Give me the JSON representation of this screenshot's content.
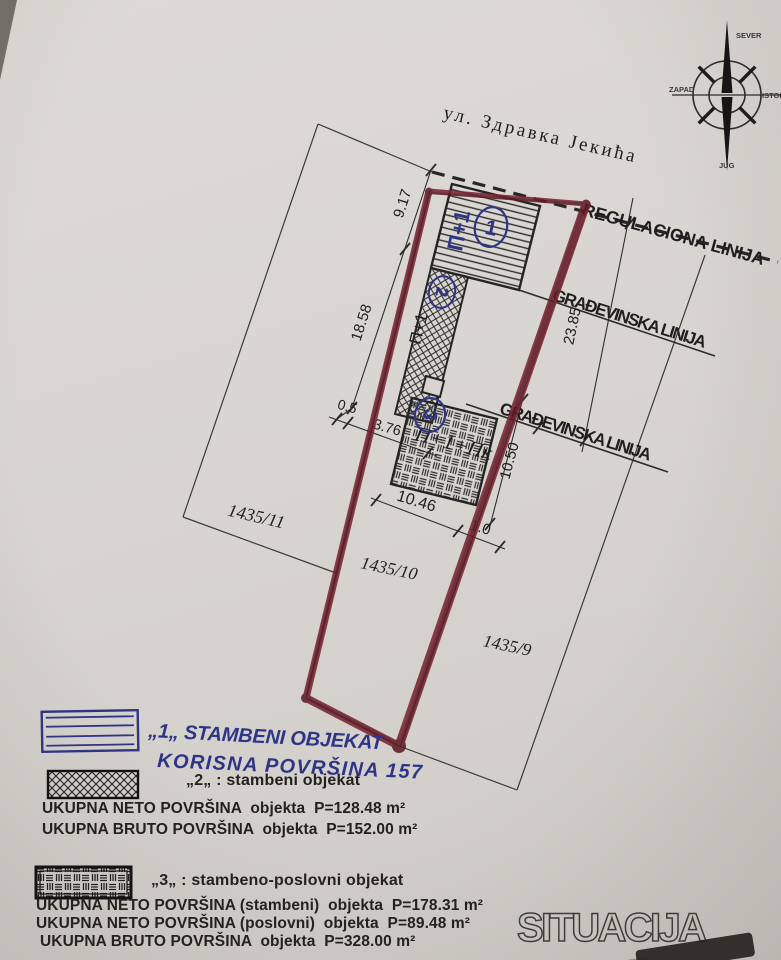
{
  "compass": {
    "north": "SEVER",
    "west": "ZAPAD",
    "east": "ISTOK",
    "south": "JUG"
  },
  "street": {
    "name": "ул. Здравка Јекића"
  },
  "plan": {
    "regulation_line": "REGULACIONA LINIJA",
    "building_line_upper": "GRAĐEVINSKA LINIJA",
    "building_line_lower": "GRAĐEVINSKA LINIJA",
    "parcel_left": "1435/11",
    "parcel_middle": "1435/10",
    "parcel_right": "1435/9",
    "dim_front_upper": "9.17",
    "dim_front_lower": "18.58",
    "dim_offset": "0.5",
    "dim_b2_width": "3.76",
    "dim_depth": "23.85",
    "dim_b3_depth": "10.50",
    "dim_b3_width": "10.46",
    "dim_side": "1.0",
    "b1_floors": "П+1",
    "b1_no": "1",
    "b2_floors": "П+1",
    "b2_no": "2",
    "b3_floors": "П+1+Пк",
    "b3_no": "3"
  },
  "handwritten": {
    "line1": "„1„ STAMBENI OBJEKAT",
    "line2": "KORISNA POVRŠINA 157"
  },
  "legend2": {
    "title": "„2„ : stambeni objekat",
    "row1": "UKUPNA NETO POVRŠINA  objekta  P=128.48 m²",
    "row2": "UKUPNA BRUTO POVRŠINA  objekta  P=152.00 m²"
  },
  "legend3": {
    "title": "„3„ : stambeno-poslovni objekat",
    "row1": "UKUPNA NETO POVRŠINA (stambeni)  objekta  P=178.31 m²",
    "row2": "UKUPNA NETO POVRŠINA (poslovni)  objekta  P=89.48 m²",
    "row3": "UKUPNA BRUTO POVRŠINA  objekta  P=328.00 m²"
  },
  "title": "SITUACIJA",
  "colors": {
    "marker_red": "#76222e",
    "ink_blue": "#2f3486",
    "paper": "#d8d5d0"
  }
}
